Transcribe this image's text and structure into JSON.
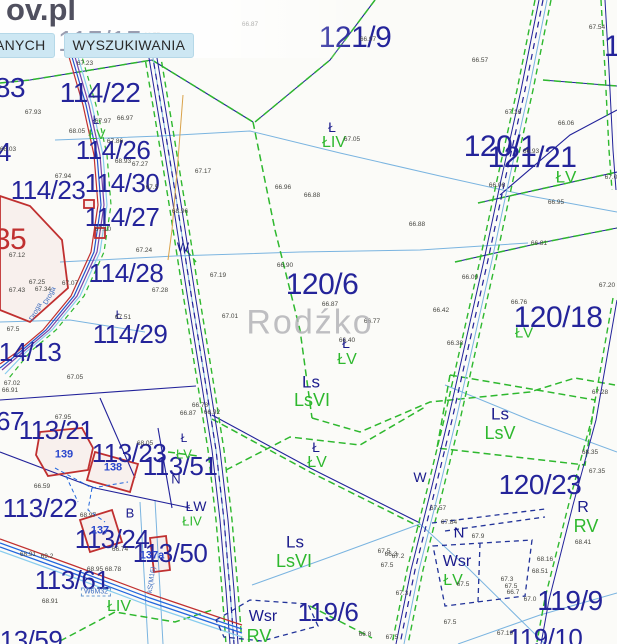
{
  "header": {
    "logo_fragment": "ov.pl",
    "parcel_watermark": "115/15",
    "tabs": [
      {
        "label": "ANYCH"
      },
      {
        "label": "WYSZUKIWANIA"
      }
    ]
  },
  "watermark": "Rodźko",
  "colors": {
    "parcel_navy": "#24249a",
    "boundary_green": "#2eb82e",
    "water_lightblue": "#7ab4e0",
    "building_red": "#c03030",
    "building_label_blue": "#2a46cc",
    "tab_bg": "#cde7f3",
    "watermark_gray": "#b4b4b8"
  },
  "map": {
    "utility_box_label": "W6M32",
    "labels": {
      "parcels": [
        {
          "t": "121/9",
          "x": 355,
          "y": 38,
          "s": 30
        },
        {
          "t": "114/22",
          "x": 100,
          "y": 93,
          "s": 28
        },
        {
          "t": "83",
          "x": 10,
          "y": 88,
          "s": 28
        },
        {
          "t": "114/26",
          "x": 113,
          "y": 150,
          "s": 26
        },
        {
          "t": "4",
          "x": 4,
          "y": 152,
          "s": 26
        },
        {
          "t": "121/21",
          "x": 532,
          "y": 158,
          "s": 30
        },
        {
          "t": "120/1",
          "x": 500,
          "y": 147,
          "s": 30
        },
        {
          "t": "114/23",
          "x": 48,
          "y": 190,
          "s": 26
        },
        {
          "t": "114/30",
          "x": 122,
          "y": 183,
          "s": 26
        },
        {
          "t": "114/27",
          "x": 122,
          "y": 217,
          "s": 26
        },
        {
          "t": "35",
          "x": 10,
          "y": 240,
          "s": 30,
          "c": "#c03030"
        },
        {
          "t": "114/28",
          "x": 126,
          "y": 273,
          "s": 26
        },
        {
          "t": "120/6",
          "x": 322,
          "y": 285,
          "s": 30
        },
        {
          "t": "120/18",
          "x": 558,
          "y": 318,
          "s": 30
        },
        {
          "t": "114/29",
          "x": 130,
          "y": 334,
          "s": 26
        },
        {
          "t": "114/13",
          "x": 24,
          "y": 352,
          "s": 26
        },
        {
          "t": "113/21",
          "x": 56,
          "y": 430,
          "s": 26
        },
        {
          "t": "67",
          "x": 10,
          "y": 421,
          "s": 26
        },
        {
          "t": "113/23",
          "x": 129,
          "y": 453,
          "s": 26
        },
        {
          "t": "113/51",
          "x": 180,
          "y": 466,
          "s": 26
        },
        {
          "t": "113/22",
          "x": 40,
          "y": 508,
          "s": 26
        },
        {
          "t": "113/24",
          "x": 112,
          "y": 539,
          "s": 26
        },
        {
          "t": "113/50",
          "x": 170,
          "y": 553,
          "s": 26
        },
        {
          "t": "113/61",
          "x": 72,
          "y": 580,
          "s": 26
        },
        {
          "t": "120/23",
          "x": 540,
          "y": 485,
          "s": 28
        },
        {
          "t": "119/6",
          "x": 328,
          "y": 612,
          "s": 26
        },
        {
          "t": "119/9",
          "x": 570,
          "y": 601,
          "s": 28
        },
        {
          "t": "119/10",
          "x": 545,
          "y": 638,
          "s": 26
        },
        {
          "t": "113/59",
          "x": 25,
          "y": 640,
          "s": 26
        },
        {
          "t": "1",
          "x": 612,
          "y": 47,
          "s": 30
        }
      ],
      "landuse_navy": [
        {
          "t": "Ł",
          "x": 332,
          "y": 127,
          "s": 14
        },
        {
          "t": "Ł",
          "x": 96,
          "y": 120,
          "s": 12
        },
        {
          "t": "W",
          "x": 183,
          "y": 247,
          "s": 13
        },
        {
          "t": "Ł",
          "x": 119,
          "y": 315,
          "s": 12
        },
        {
          "t": "Ł",
          "x": 346,
          "y": 343,
          "s": 14
        },
        {
          "t": "Ls",
          "x": 311,
          "y": 382,
          "s": 17
        },
        {
          "t": "Ł",
          "x": 316,
          "y": 447,
          "s": 14
        },
        {
          "t": "Ls",
          "x": 500,
          "y": 414,
          "s": 17
        },
        {
          "t": "Ł",
          "x": 184,
          "y": 438,
          "s": 12
        },
        {
          "t": "N",
          "x": 176,
          "y": 479,
          "s": 13
        },
        {
          "t": "ŁW",
          "x": 196,
          "y": 506,
          "s": 14
        },
        {
          "t": "B",
          "x": 130,
          "y": 513,
          "s": 13
        },
        {
          "t": "W",
          "x": 420,
          "y": 477,
          "s": 14
        },
        {
          "t": "N",
          "x": 459,
          "y": 533,
          "s": 15
        },
        {
          "t": "Wsr",
          "x": 457,
          "y": 562,
          "s": 16
        },
        {
          "t": "R",
          "x": 583,
          "y": 508,
          "s": 16
        },
        {
          "t": "Ls",
          "x": 295,
          "y": 542,
          "s": 17
        },
        {
          "t": "Wsr",
          "x": 263,
          "y": 617,
          "s": 16
        }
      ],
      "landuse_green": [
        {
          "t": "ŁIV",
          "x": 334,
          "y": 143,
          "s": 16
        },
        {
          "t": "ŁV",
          "x": 97,
          "y": 134,
          "s": 14
        },
        {
          "t": "ŁV",
          "x": 566,
          "y": 177,
          "s": 17
        },
        {
          "t": "ŁV",
          "x": 524,
          "y": 333,
          "s": 15
        },
        {
          "t": "ŁV",
          "x": 347,
          "y": 360,
          "s": 16
        },
        {
          "t": "LsVI",
          "x": 312,
          "y": 400,
          "s": 18
        },
        {
          "t": "ŁV",
          "x": 317,
          "y": 463,
          "s": 16
        },
        {
          "t": "LsV",
          "x": 500,
          "y": 433,
          "s": 18
        },
        {
          "t": "ŁV",
          "x": 184,
          "y": 454,
          "s": 13
        },
        {
          "t": "ŁIV",
          "x": 192,
          "y": 521,
          "s": 13
        },
        {
          "t": "ŁV",
          "x": 453,
          "y": 581,
          "s": 16
        },
        {
          "t": "RV",
          "x": 586,
          "y": 526,
          "s": 18
        },
        {
          "t": "LsVI",
          "x": 294,
          "y": 561,
          "s": 18
        },
        {
          "t": "RV",
          "x": 259,
          "y": 636,
          "s": 18
        },
        {
          "t": "ŁIV",
          "x": 119,
          "y": 607,
          "s": 16
        }
      ],
      "elevations": [
        {
          "t": "66.87",
          "x": 250,
          "y": 25
        },
        {
          "t": "66.97",
          "x": 368,
          "y": 40
        },
        {
          "t": "67.23",
          "x": 85,
          "y": 64
        },
        {
          "t": "66.77",
          "x": 152,
          "y": 36
        },
        {
          "t": "67.93",
          "x": 33,
          "y": 113
        },
        {
          "t": "67.97",
          "x": 103,
          "y": 122
        },
        {
          "t": "66.97",
          "x": 125,
          "y": 119
        },
        {
          "t": "68.05",
          "x": 77,
          "y": 132
        },
        {
          "t": "67.86",
          "x": 115,
          "y": 142
        },
        {
          "t": "68.03",
          "x": 8,
          "y": 150
        },
        {
          "t": "66.57",
          "x": 480,
          "y": 61
        },
        {
          "t": "67.54",
          "x": 597,
          "y": 28
        },
        {
          "t": "67.16",
          "x": 513,
          "y": 113
        },
        {
          "t": "66.06",
          "x": 566,
          "y": 124
        },
        {
          "t": "66.93",
          "x": 531,
          "y": 152
        },
        {
          "t": "67.0",
          "x": 611,
          "y": 178
        },
        {
          "t": "66.06",
          "x": 497,
          "y": 186
        },
        {
          "t": "67.05",
          "x": 352,
          "y": 140
        },
        {
          "t": "67.17",
          "x": 203,
          "y": 172
        },
        {
          "t": "66.96",
          "x": 283,
          "y": 188
        },
        {
          "t": "66.88",
          "x": 312,
          "y": 196
        },
        {
          "t": "66.88",
          "x": 417,
          "y": 225
        },
        {
          "t": "66.90",
          "x": 285,
          "y": 266
        },
        {
          "t": "67.19",
          "x": 218,
          "y": 276
        },
        {
          "t": "66.87",
          "x": 330,
          "y": 305
        },
        {
          "t": "67.01",
          "x": 230,
          "y": 317
        },
        {
          "t": "66.77",
          "x": 372,
          "y": 322
        },
        {
          "t": "66.95",
          "x": 556,
          "y": 203
        },
        {
          "t": "66.81",
          "x": 539,
          "y": 244
        },
        {
          "t": "66.09",
          "x": 470,
          "y": 278
        },
        {
          "t": "66.42",
          "x": 441,
          "y": 311
        },
        {
          "t": "66.76",
          "x": 519,
          "y": 303
        },
        {
          "t": "67.20",
          "x": 607,
          "y": 286
        },
        {
          "t": "66.38",
          "x": 455,
          "y": 344
        },
        {
          "t": "67.24",
          "x": 144,
          "y": 251
        },
        {
          "t": "67.07",
          "x": 70,
          "y": 284
        },
        {
          "t": "67.28",
          "x": 160,
          "y": 291
        },
        {
          "t": "67.25",
          "x": 37,
          "y": 283
        },
        {
          "t": "67.34",
          "x": 43,
          "y": 290
        },
        {
          "t": "67.12",
          "x": 17,
          "y": 256
        },
        {
          "t": "67.43",
          "x": 17,
          "y": 291
        },
        {
          "t": "67.51",
          "x": 123,
          "y": 318
        },
        {
          "t": "67.5",
          "x": 13,
          "y": 330
        },
        {
          "t": "67.05",
          "x": 75,
          "y": 378
        },
        {
          "t": "67.02",
          "x": 12,
          "y": 384
        },
        {
          "t": "67.94",
          "x": 63,
          "y": 177
        },
        {
          "t": "67.5",
          "x": 152,
          "y": 188
        },
        {
          "t": "68.96",
          "x": 180,
          "y": 212
        },
        {
          "t": "68.93",
          "x": 123,
          "y": 162
        },
        {
          "t": "67.27",
          "x": 140,
          "y": 165
        },
        {
          "t": "67.10",
          "x": 103,
          "y": 230
        },
        {
          "t": "66.78",
          "x": 200,
          "y": 406
        },
        {
          "t": "66.87",
          "x": 188,
          "y": 414
        },
        {
          "t": "66.92",
          "x": 212,
          "y": 413
        },
        {
          "t": "66.40",
          "x": 347,
          "y": 341
        },
        {
          "t": "67.95",
          "x": 63,
          "y": 418
        },
        {
          "t": "68.05",
          "x": 145,
          "y": 444
        },
        {
          "t": "66.59",
          "x": 42,
          "y": 487
        },
        {
          "t": "66.91",
          "x": 10,
          "y": 391
        },
        {
          "t": "68.97",
          "x": 88,
          "y": 516
        },
        {
          "t": "66.74",
          "x": 120,
          "y": 550
        },
        {
          "t": "68.91",
          "x": 28,
          "y": 555
        },
        {
          "t": "69.2",
          "x": 47,
          "y": 557
        },
        {
          "t": "68.95",
          "x": 95,
          "y": 570
        },
        {
          "t": "68.78",
          "x": 113,
          "y": 570
        },
        {
          "t": "68.91",
          "x": 50,
          "y": 602
        },
        {
          "t": "68.16",
          "x": 545,
          "y": 560
        },
        {
          "t": "68.51",
          "x": 540,
          "y": 572
        },
        {
          "t": "68.41",
          "x": 583,
          "y": 543
        },
        {
          "t": "67.57",
          "x": 438,
          "y": 509
        },
        {
          "t": "67.84",
          "x": 449,
          "y": 523
        },
        {
          "t": "67.9",
          "x": 478,
          "y": 537
        },
        {
          "t": "67.3",
          "x": 507,
          "y": 580
        },
        {
          "t": "67.5",
          "x": 511,
          "y": 587
        },
        {
          "t": "66.7",
          "x": 513,
          "y": 593
        },
        {
          "t": "67.0",
          "x": 530,
          "y": 600
        },
        {
          "t": "67.5",
          "x": 463,
          "y": 585
        },
        {
          "t": "67.5",
          "x": 450,
          "y": 623
        },
        {
          "t": "67.19",
          "x": 505,
          "y": 634
        },
        {
          "t": "67.28",
          "x": 600,
          "y": 393
        },
        {
          "t": "68.35",
          "x": 590,
          "y": 453
        },
        {
          "t": "67.35",
          "x": 597,
          "y": 472
        },
        {
          "t": "67.5",
          "x": 384,
          "y": 552
        },
        {
          "t": "66.3",
          "x": 391,
          "y": 555
        },
        {
          "t": "67.2",
          "x": 398,
          "y": 557
        },
        {
          "t": "67.5",
          "x": 387,
          "y": 566
        },
        {
          "t": "67.3",
          "x": 402,
          "y": 594
        },
        {
          "t": "67.5",
          "x": 392,
          "y": 638
        },
        {
          "t": "66.8",
          "x": 365,
          "y": 635
        }
      ],
      "buildings": [
        {
          "t": "139",
          "x": 64,
          "y": 455
        },
        {
          "t": "138",
          "x": 113,
          "y": 468
        },
        {
          "t": "137",
          "x": 100,
          "y": 531
        },
        {
          "t": "137a",
          "x": 152,
          "y": 556
        }
      ],
      "rotated": [
        {
          "t": "Droga",
          "x": 36,
          "y": 312,
          "r": -62
        },
        {
          "t": "Droga",
          "x": 50,
          "y": 296,
          "r": -62
        },
        {
          "t": "kS(M16)",
          "x": 152,
          "y": 580,
          "r": -82
        }
      ]
    }
  }
}
